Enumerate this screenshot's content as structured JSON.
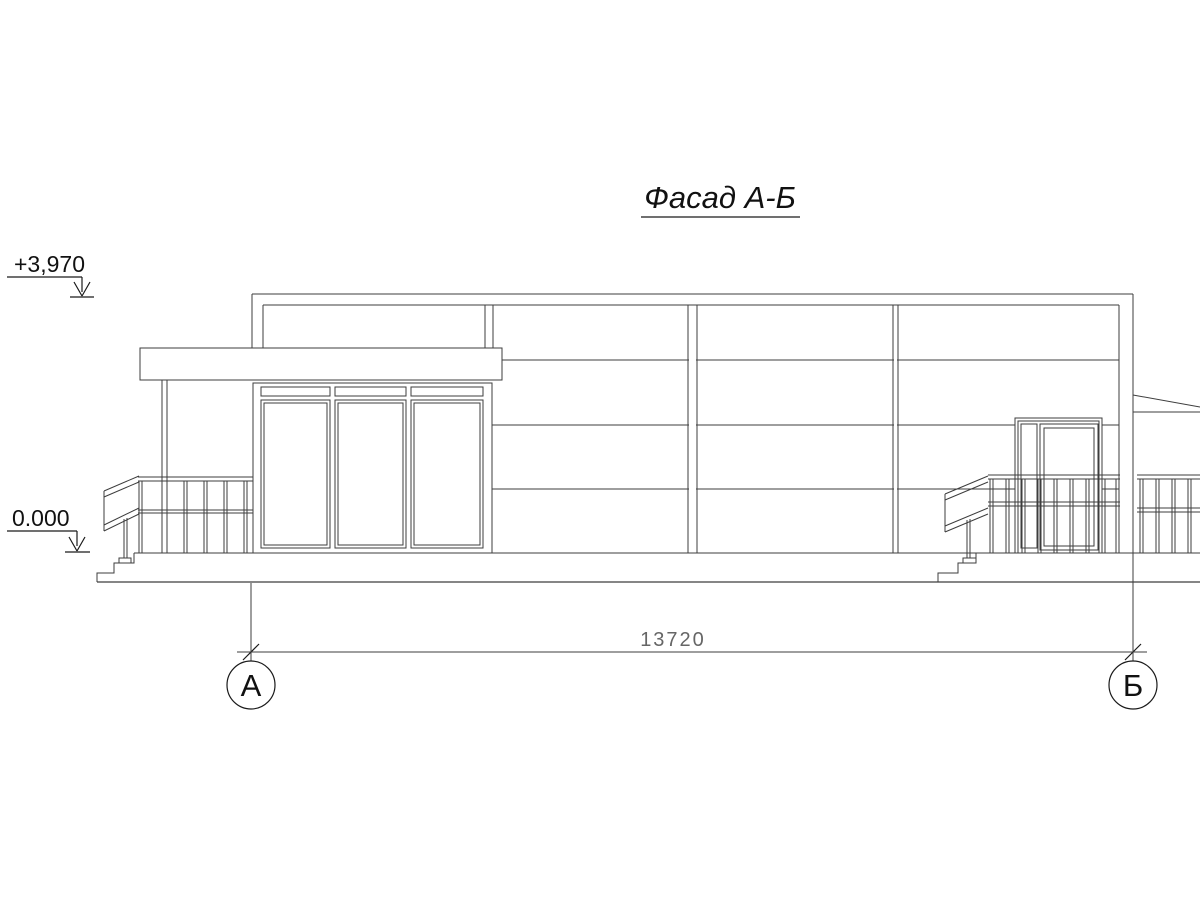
{
  "meta": {
    "background_color": "#ffffff",
    "line_color": "#3d3d3d",
    "text_color": "#111111",
    "dim_text_color": "#666666",
    "drawing_type": "facade-elevation"
  },
  "title": {
    "text": "Фасад А-Б"
  },
  "elevation_marks": {
    "top": "+3,970",
    "bottom": "0.000"
  },
  "dimension": {
    "value": "13720"
  },
  "axes": {
    "left_label": "А",
    "right_label": "Б"
  }
}
